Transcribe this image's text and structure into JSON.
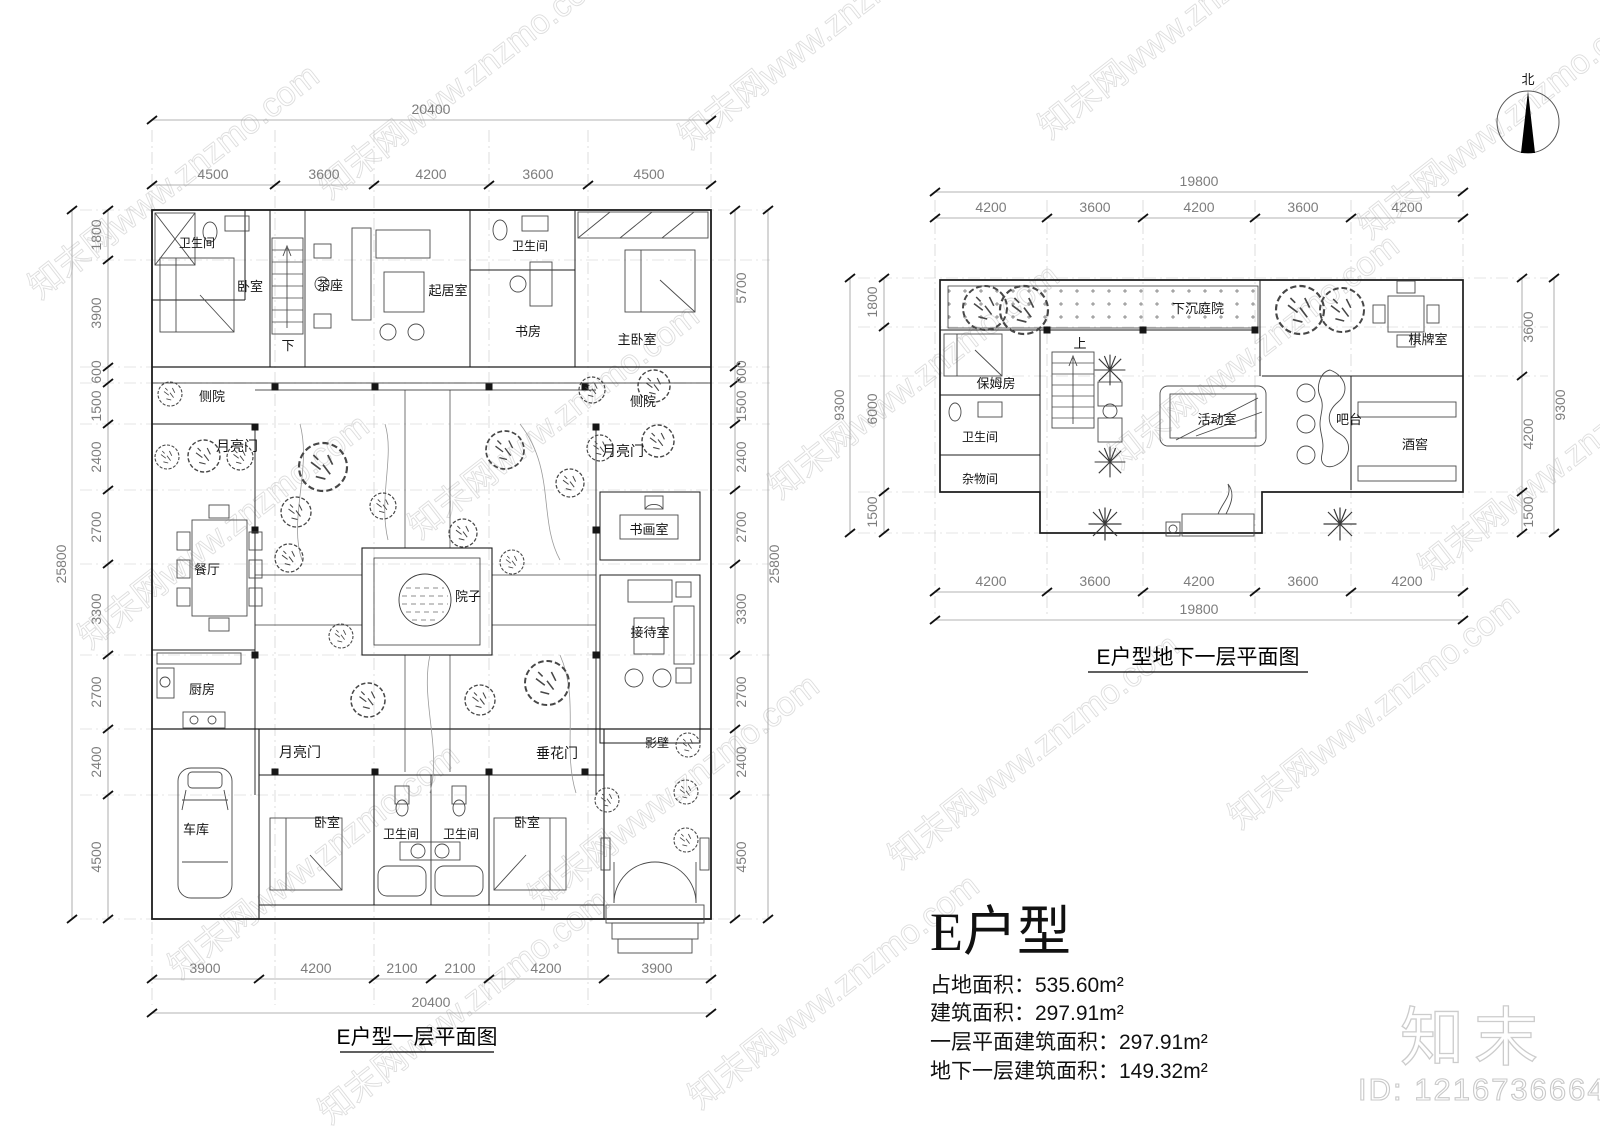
{
  "watermark": {
    "tile_text": "知末网www.znzmo.com",
    "logo_text": "知末",
    "id_text": "ID: 1216736664"
  },
  "north": {
    "label": "北"
  },
  "plan1": {
    "title": "E户型一层平面图",
    "dims": {
      "top_total": "20400",
      "top_segments": [
        "4500",
        "3600",
        "4200",
        "3600",
        "4500"
      ],
      "bottom_total": "20400",
      "bottom_segments": [
        "3900",
        "4200",
        "2100",
        "2100",
        "4200",
        "3900"
      ],
      "left_total": "25800",
      "left_segments": [
        "1800",
        "3900",
        "600",
        "1500",
        "2400",
        "2700",
        "3300",
        "2700",
        "2400",
        "4500"
      ],
      "right_total": "25800",
      "right_segments": [
        "5700",
        "600",
        "1500",
        "2400",
        "2700",
        "3300",
        "2700",
        "2400",
        "4500"
      ]
    },
    "rooms": {
      "bath1": "卫生间",
      "bed1": "卧室",
      "stair_down": "下",
      "tea": "茶座",
      "living": "起居室",
      "bath2": "卫生间",
      "study": "书房",
      "master": "主卧室",
      "side_l": "侧院",
      "side_r": "侧院",
      "moon_tl": "月亮门",
      "moon_tr": "月亮门",
      "dining": "餐厅",
      "art": "书画室",
      "yard": "院子",
      "reception": "接待室",
      "kitchen": "厨房",
      "moon_b": "月亮门",
      "flower_gate": "垂花门",
      "screen": "影壁",
      "garage": "车库",
      "bed2": "卧室",
      "bath3": "卫生间",
      "bath4": "卫生间",
      "bed3": "卧室"
    }
  },
  "plan2": {
    "title": "E户型地下一层平面图",
    "dims": {
      "top_total": "19800",
      "top_segments": [
        "4200",
        "3600",
        "4200",
        "3600",
        "4200"
      ],
      "bottom_total": "19800",
      "bottom_segments": [
        "4200",
        "3600",
        "4200",
        "3600",
        "4200"
      ],
      "left_total": "9300",
      "left_segments": [
        "1800",
        "6000",
        "1500"
      ],
      "right_total": "9300",
      "right_segments": [
        "3600",
        "4200",
        "1500"
      ]
    },
    "rooms": {
      "sunken": "下沉庭院",
      "chess": "棋牌室",
      "nanny": "保姆房",
      "bath": "卫生间",
      "storage": "杂物间",
      "stair_up": "上",
      "activity": "活动室",
      "bar": "吧台",
      "wine": "酒窖"
    }
  },
  "info": {
    "title": "E户型",
    "lines": [
      "占地面积：535.60m²",
      "建筑面积：297.91m²",
      "一层平面建筑面积：297.91m²",
      "地下一层建筑面积：149.32m²"
    ]
  }
}
